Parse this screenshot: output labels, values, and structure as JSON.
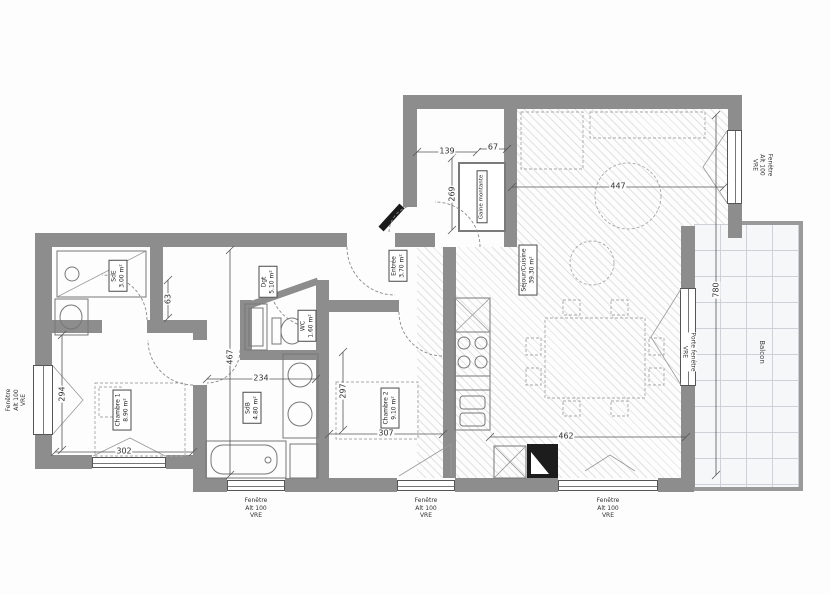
{
  "plan": {
    "rooms": [
      {
        "name": "Séjour/Cuisine",
        "area": "39.30 m²"
      },
      {
        "name": "Chambre 1",
        "area": "8.90 m²"
      },
      {
        "name": "Chambre 2",
        "area": "9.10 m²"
      },
      {
        "name": "SdB",
        "area": "4.80 m²"
      },
      {
        "name": "SdE",
        "area": "3.00 m²"
      },
      {
        "name": "WC",
        "area": "1.60 m²"
      },
      {
        "name": "Dgt",
        "area": "5.10 m²"
      },
      {
        "name": "Entrée",
        "area": "3.70 m²"
      },
      {
        "name": "Gaine montante",
        "area": ""
      }
    ],
    "outdoor": {
      "balcony_label": "Balcon"
    },
    "openings": {
      "window_label": "Fenêtre",
      "window_sub": "Alt 100",
      "window_type": "VRE",
      "door_label": "Porte fenêtre",
      "door_type": "VRE"
    },
    "dimensions": {
      "entry_width": "139",
      "gaine_width": "67",
      "entry_height": "269",
      "sejour_width_top": "447",
      "sejour_height": "780",
      "sejour_width_bottom": "462",
      "ch1_width": "302",
      "ch1_height": "294",
      "middle_height": "467",
      "sdb_width": "234",
      "corridor_width": "63",
      "ch2_height": "297",
      "ch2_width": "307"
    }
  }
}
